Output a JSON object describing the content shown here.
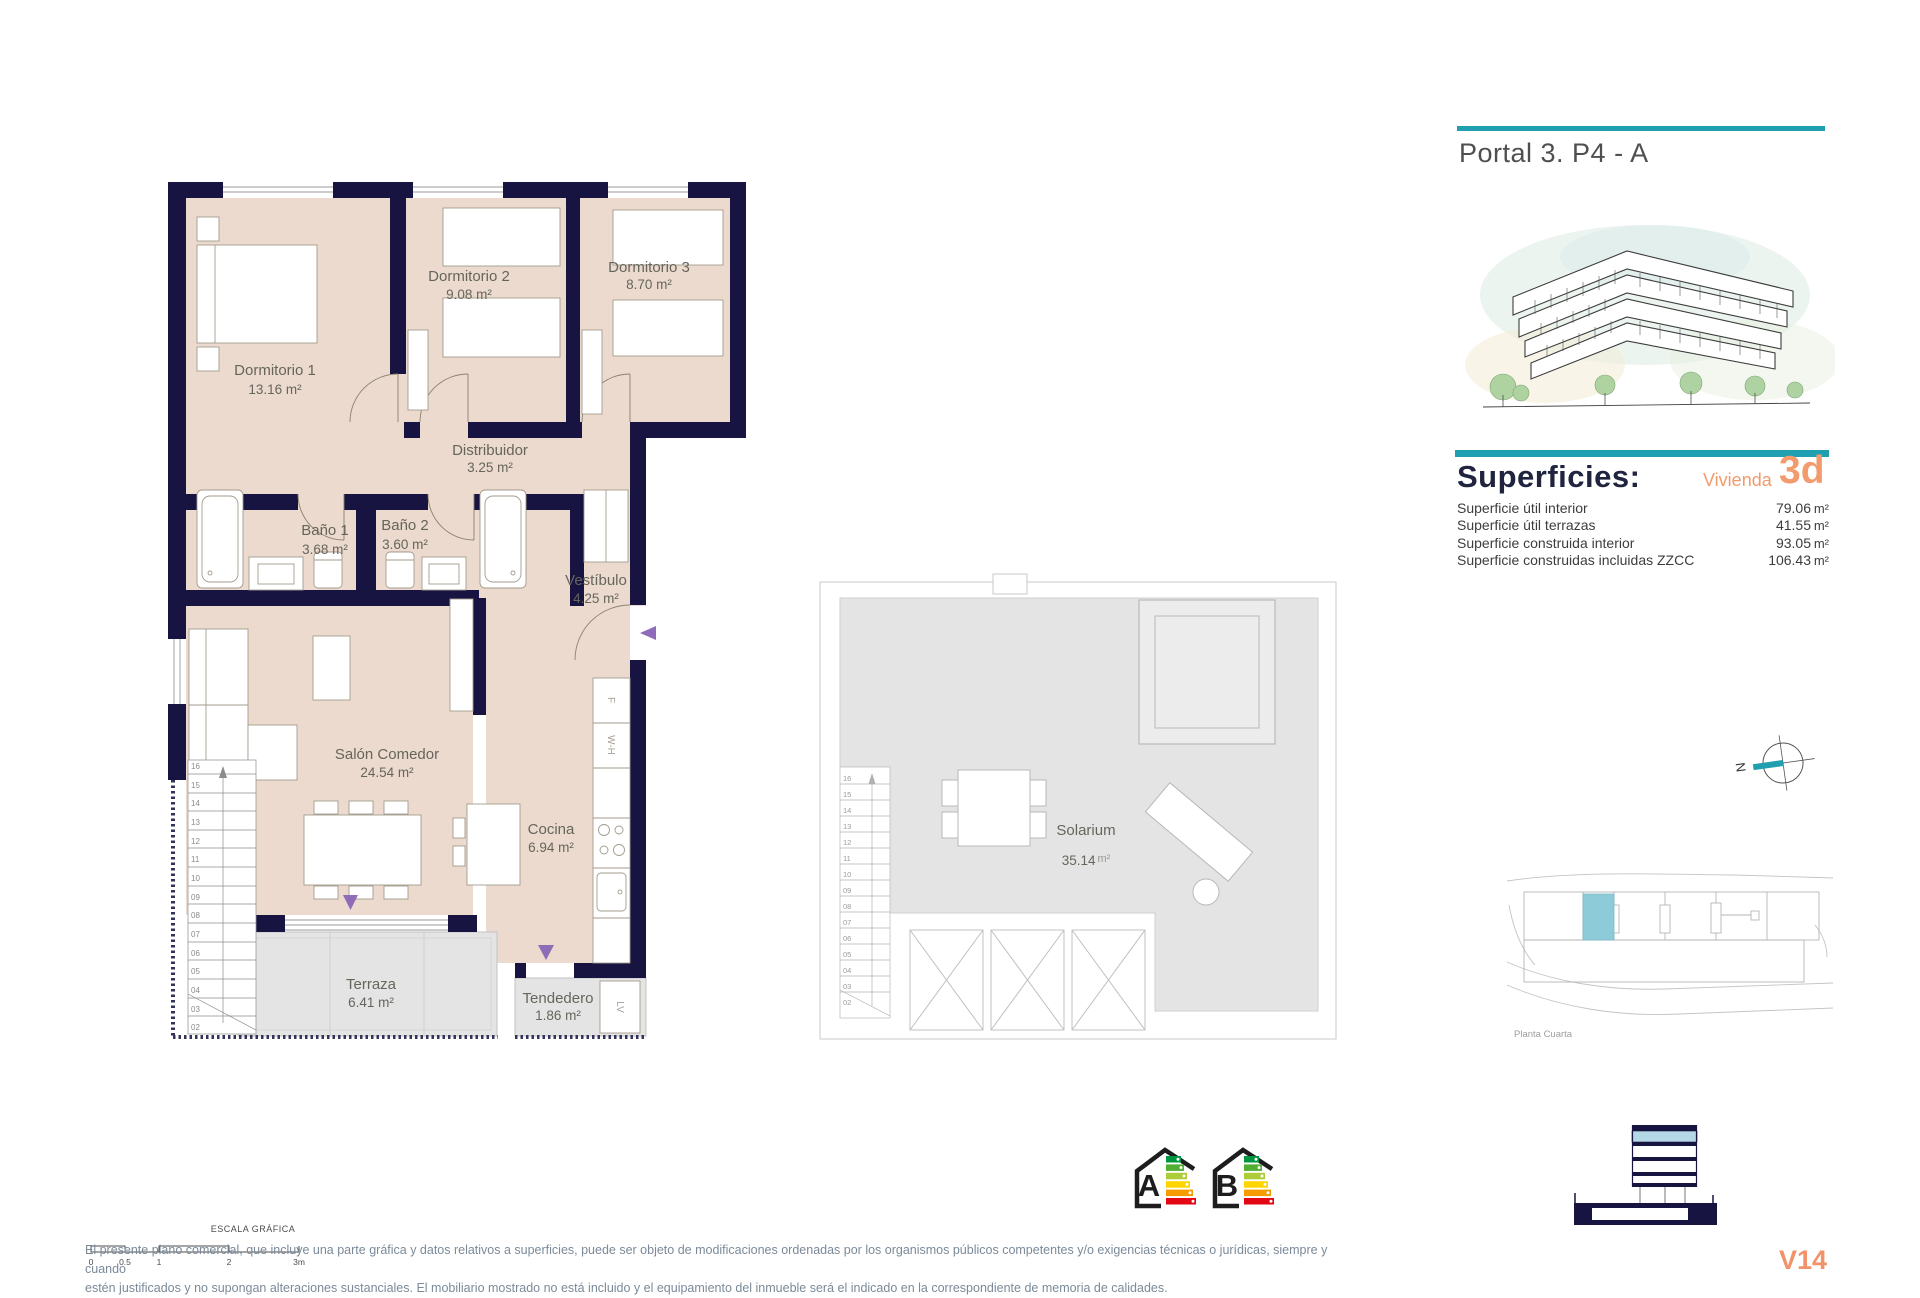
{
  "header": {
    "title": "Portal 3. P4 - A"
  },
  "colors": {
    "accent_teal": "#1f9faf",
    "accent_orange": "#f29b6c",
    "wall_navy": "#171441",
    "floor_beige": "#ebdacd",
    "terrace_gray": "#e4e4e4",
    "arrow_purple": "#8f6cb8",
    "highlight_unit_blue": "#8ecbd8",
    "section_floor_blue": "#b5d8e6"
  },
  "superficies": {
    "heading": "Superficies:",
    "vivienda_label": "Vivienda",
    "vivienda_code": "3d",
    "rows": [
      {
        "label": "Superficie útil interior",
        "value": "79.06",
        "unit": "m²"
      },
      {
        "label": "Superficie útil terrazas",
        "value": "41.55",
        "unit": "m²"
      },
      {
        "label": "Superficie construida interior",
        "value": "93.05",
        "unit": "m²"
      },
      {
        "label": "Superficie construidas incluidas ZZCC",
        "value": "106.43",
        "unit": "m²"
      }
    ]
  },
  "floor_plan": {
    "rooms": {
      "dormitorio1": {
        "name": "Dormitorio 1",
        "area": "13.16 m²"
      },
      "dormitorio2": {
        "name": "Dormitorio 2",
        "area": "9.08 m²"
      },
      "dormitorio3": {
        "name": "Dormitorio 3",
        "area": "8.70 m²"
      },
      "distribuidor": {
        "name": "Distribuidor",
        "area": "3.25 m²"
      },
      "bano1": {
        "name": "Baño 1",
        "area": "3.68 m²"
      },
      "bano2": {
        "name": "Baño 2",
        "area": "3.60 m²"
      },
      "vestibulo": {
        "name": "Vestíbulo",
        "area": "4.25 m²"
      },
      "salon": {
        "name": "Salón Comedor",
        "area": "24.54 m²"
      },
      "cocina": {
        "name": "Cocina",
        "area": "6.94 m²"
      },
      "terraza": {
        "name": "Terraza",
        "area": "6.41 m²"
      },
      "tendedero": {
        "name": "Tendedero",
        "area": "1.86 m²"
      }
    },
    "stair_numbers_main": [
      "16",
      "15",
      "14",
      "13",
      "12",
      "11",
      "10",
      "09",
      "08",
      "07",
      "06",
      "05",
      "04",
      "03",
      "02"
    ],
    "appliance_labels": {
      "fridge": "F",
      "water_heater": "W-H",
      "washer": "LV"
    }
  },
  "solarium_plan": {
    "name": "Solarium",
    "area": "35.14",
    "area_unit": "m²",
    "stair_numbers": [
      "16",
      "15",
      "14",
      "13",
      "12",
      "11",
      "10",
      "09",
      "08",
      "07",
      "06",
      "05",
      "04",
      "03",
      "02"
    ]
  },
  "compass": {
    "north_label": "N"
  },
  "site_plan": {
    "caption": "Planta Cuarta"
  },
  "energy": {
    "ratings": [
      "A",
      "B"
    ],
    "bar_colors": [
      "#009640",
      "#52ae32",
      "#aecc38",
      "#ffd500",
      "#f59c00",
      "#e30613"
    ]
  },
  "scale_bar": {
    "title": "ESCALA GRÁFICA",
    "ticks": [
      "0",
      "0.5",
      "1",
      "2",
      "3m"
    ]
  },
  "footer": {
    "disclaimer_line1": "El presente plano comercial, que incluye una parte gráfica y datos relativos a superficies, puede ser objeto de modificaciones ordenadas por los organismos públicos competentes y/o exigencias técnicas o jurídicas, siempre y cuando",
    "disclaimer_line2": "estén justificados y no supongan alteraciones sustanciales. El mobiliario mostrado no está incluido y el equipamiento del inmueble será el indicado en la correspondiente de memoria de calidades.",
    "version": "V14"
  }
}
